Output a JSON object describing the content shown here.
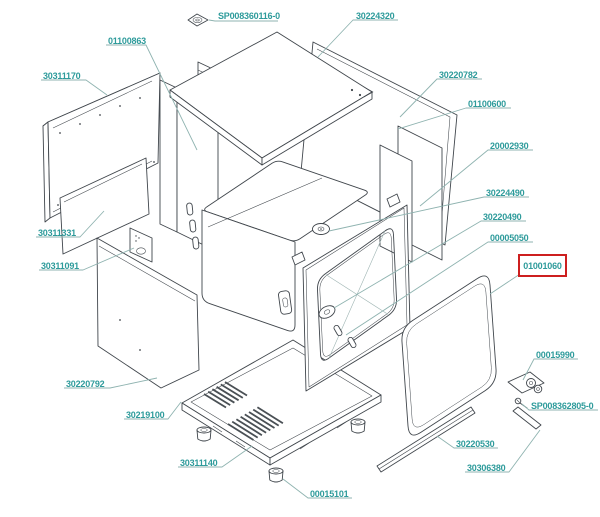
{
  "diagram": {
    "type": "exploded-parts-diagram",
    "background": "#ffffff",
    "label_color": "#2e9b9b",
    "leader_color": "#8fb3b0",
    "line_color": "#40464c",
    "highlight_box_color": "#cd1f1f",
    "highlighted_part": "01001060"
  },
  "part_labels": [
    "SP008360116-0",
    "30224320",
    "01100863",
    "30311170",
    "30220782",
    "01100600",
    "20002930",
    "30224490",
    "30220490",
    "00005050",
    "01001060",
    "30311331",
    "30311091",
    "30220792",
    "30219100",
    "30311140",
    "00015101",
    "00015990",
    "SP008362805-0",
    "30220530",
    "30306380"
  ]
}
